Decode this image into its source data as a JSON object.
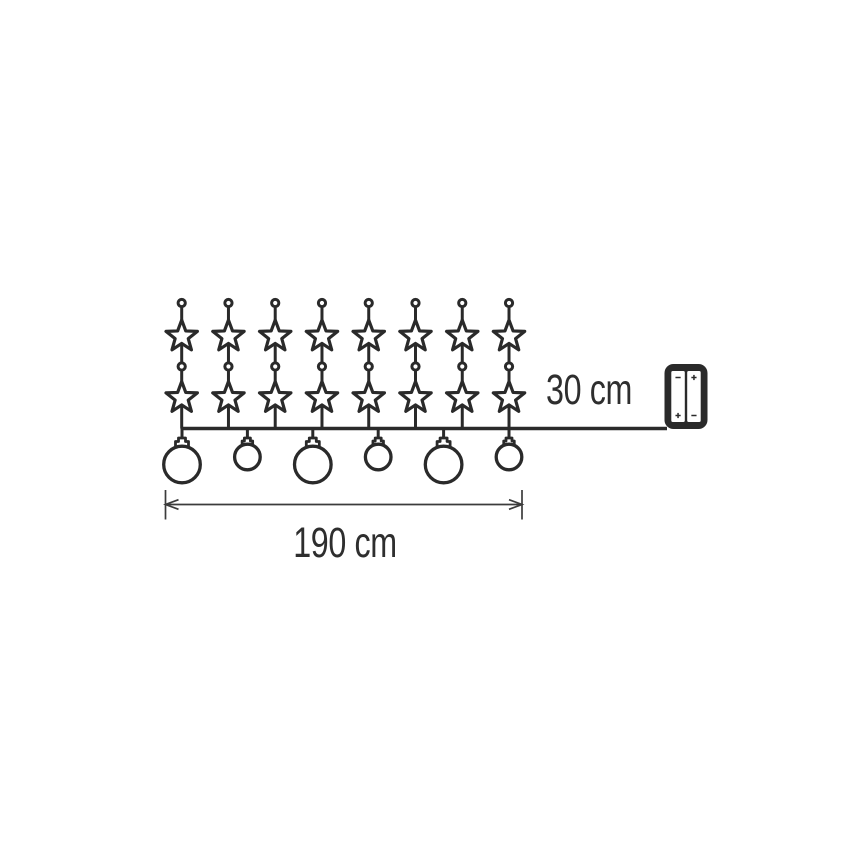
{
  "page": {
    "width": 868,
    "height": 868,
    "background": "#ffffff"
  },
  "colors": {
    "ink": "#2a2a2a",
    "dim_line": "#3c3c3c",
    "text": "#2e2e2e",
    "paper": "#ffffff"
  },
  "labels": {
    "lead_length": "30 cm",
    "total_length": "190 cm"
  },
  "diagram": {
    "cable": {
      "y": 428.5,
      "x1": 181.7,
      "x2": 667
    },
    "strings": {
      "count": 8,
      "x_start": 181.7,
      "x_spacing": 46.76,
      "top_dot_y": 303,
      "mid_dot_y": 366.5,
      "dot_radius": 3.6,
      "star1_y": 336.5,
      "star2_y": 398,
      "star_outer_radius": 16.5,
      "star_inner_radius": 6.9
    },
    "bulbs": {
      "count": 6,
      "x_start": 182,
      "x_spacing": 65.4,
      "pattern": [
        "large",
        "small",
        "large",
        "small",
        "large",
        "small"
      ],
      "cap_top_y": 438,
      "large": {
        "radius": 18.3,
        "center_y": 464.5,
        "neck_w": 7,
        "neck_h": 3.5,
        "collar_w": 13,
        "collar_h": 6
      },
      "small": {
        "radius": 12.8,
        "center_y": 457,
        "neck_w": 6,
        "neck_h": 3,
        "collar_w": 10.5,
        "collar_h": 5
      }
    },
    "battery_pack": {
      "x": 664.5,
      "y": 364,
      "width": 43,
      "height": 65,
      "corner_radius": 9,
      "cell_top": 371,
      "cell_height": 51,
      "side_margin": 6.8,
      "divider": 2.4,
      "cells": [
        {
          "top_symbol": "-",
          "bottom_symbol": "+"
        },
        {
          "top_symbol": "+",
          "bottom_symbol": "-"
        }
      ]
    },
    "dimension_line": {
      "x1": 165.5,
      "x2": 522,
      "y": 504.5,
      "tick_top": 490,
      "tick_bottom": 519.5,
      "arrow_len": 13,
      "arrow_half": 4.8
    },
    "label_positions": {
      "lead": {
        "cx": 589,
        "cy": 390
      },
      "total": {
        "cx": 345,
        "cy": 543
      }
    }
  }
}
